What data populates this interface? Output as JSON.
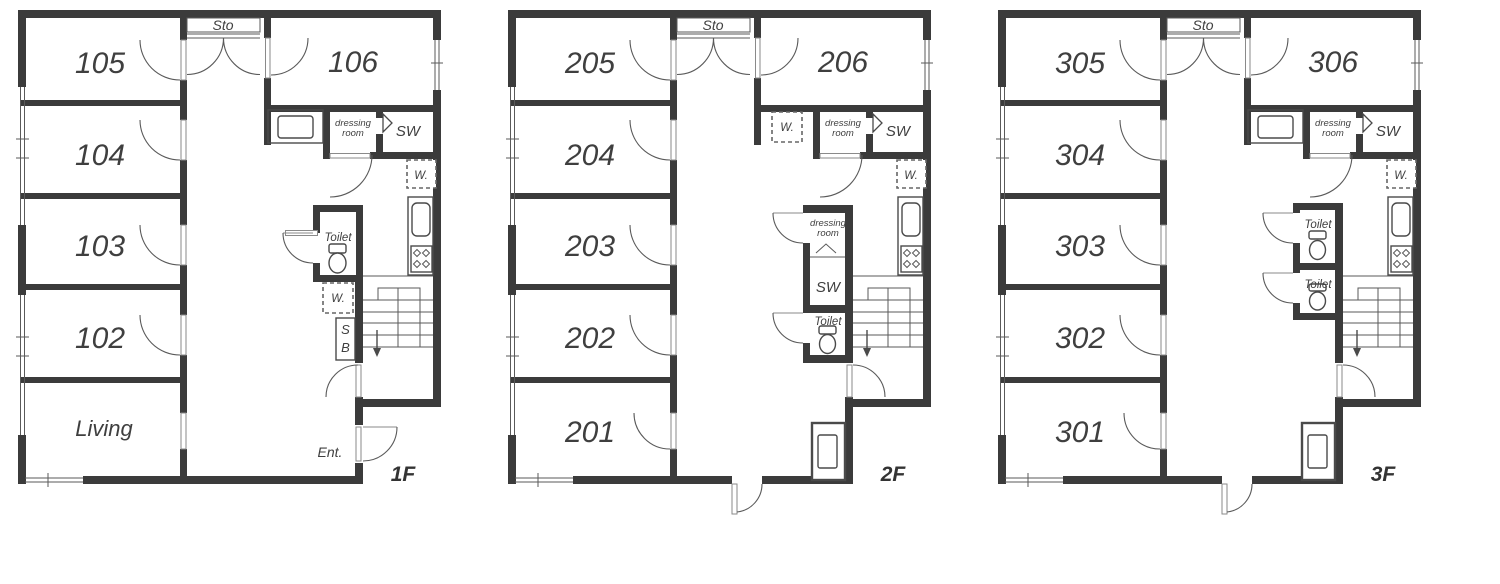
{
  "floors": [
    {
      "name": "1F",
      "rooms": [
        "105",
        "104",
        "103",
        "102"
      ],
      "bottom_room": "Living",
      "storage": "Sto",
      "room_right": "106",
      "dressing_line1": "dressing",
      "dressing_line2": "room",
      "shower": "SW",
      "washer_kitchen": "W.",
      "toilet": "Toilet",
      "washer_hall": "W.",
      "shoe_box_line1": "S",
      "shoe_box_line2": "B",
      "entrance": "Ent.",
      "floor_label": "1F"
    },
    {
      "name": "2F",
      "rooms": [
        "205",
        "204",
        "203",
        "202"
      ],
      "bottom_room": "201",
      "storage": "Sto",
      "room_right": "206",
      "washer_service": "W.",
      "dressing_line1": "dressing",
      "dressing_line2": "room",
      "shower": "SW",
      "washer_kitchen": "W.",
      "dressing2_line1": "dressing",
      "dressing2_line2": "room",
      "shower2": "SW",
      "toilet": "Toilet",
      "floor_label": "2F"
    },
    {
      "name": "3F",
      "rooms": [
        "305",
        "304",
        "303",
        "302"
      ],
      "bottom_room": "301",
      "storage": "Sto",
      "room_right": "306",
      "dressing_line1": "dressing",
      "dressing_line2": "room",
      "shower": "SW",
      "washer_kitchen": "W.",
      "toilet_upper": "Toilet",
      "toilet_lower": "Toilet",
      "floor_label": "3F"
    }
  ],
  "colors": {
    "wall": "#3b3b3b",
    "line": "#4a4a4a",
    "text": "#3f3f3f"
  }
}
